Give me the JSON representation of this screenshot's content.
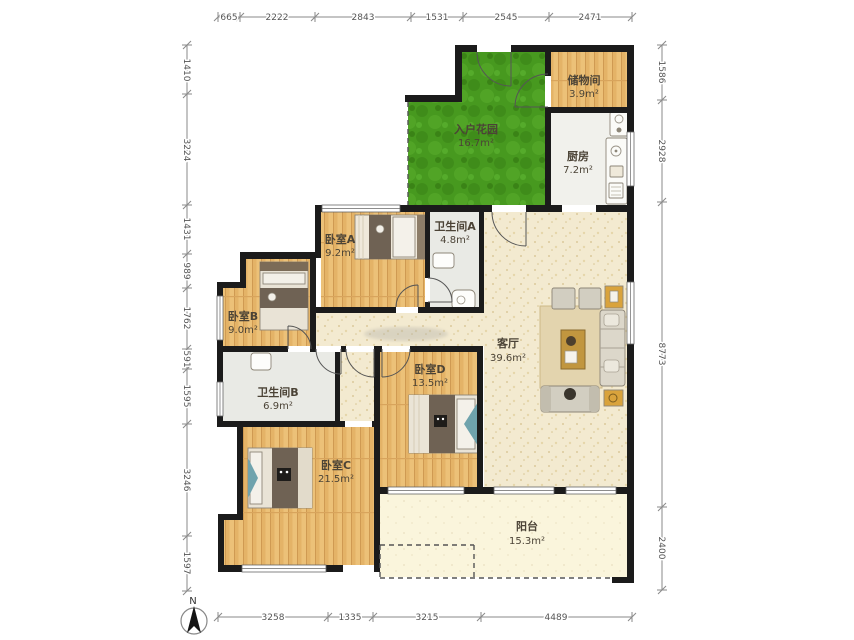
{
  "dimensions": {
    "top": [
      "665",
      "2222",
      "2843",
      "1531",
      "2545",
      "2471"
    ],
    "left": [
      "1410",
      "3224",
      "1431",
      "989",
      "1762",
      "591",
      "1595",
      "3246",
      "1597"
    ],
    "right": [
      "1586",
      "2928",
      "8773",
      "2400"
    ],
    "bottom": [
      "3258",
      "1335",
      "3215",
      "4489"
    ]
  },
  "rooms": {
    "garden": {
      "name": "入户花园",
      "area": "16.7m²"
    },
    "storage": {
      "name": "储物间",
      "area": "3.9m²"
    },
    "kitchen": {
      "name": "厨房",
      "area": "7.2m²"
    },
    "bedroomA": {
      "name": "卧室A",
      "area": "9.2m²"
    },
    "bathA": {
      "name": "卫生间A",
      "area": "4.8m²"
    },
    "bedroomB": {
      "name": "卧室B",
      "area": "9.0m²"
    },
    "bathB": {
      "name": "卫生间B",
      "area": "6.9m²"
    },
    "bedroomC": {
      "name": "卧室C",
      "area": "21.5m²"
    },
    "bedroomD": {
      "name": "卧室D",
      "area": "13.5m²"
    },
    "living": {
      "name": "客厅",
      "area": "39.6m²"
    },
    "balcony": {
      "name": "阳台",
      "area": "15.3m²"
    }
  },
  "compass": {
    "label": "N"
  },
  "colors": {
    "wall": "#1b1b1b",
    "wood": "#eabf74",
    "grass": "#47991f",
    "hall": "#f3ead0",
    "bath": "#e9eae5",
    "kitchen": "#f1f1ec",
    "balcony": "#faf5dc",
    "accent_yellow": "#d9a33c"
  }
}
